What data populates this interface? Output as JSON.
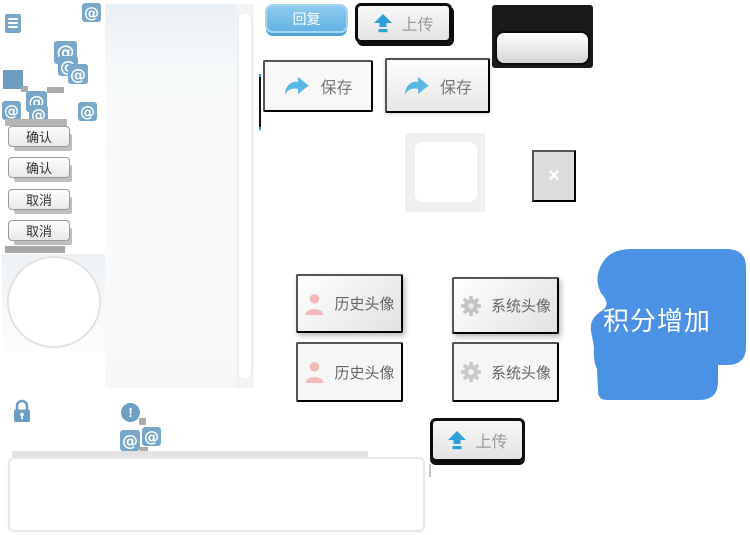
{
  "labels": {
    "reply": "回复",
    "upload": "上传",
    "save": "保存",
    "confirm": "确认",
    "cancel": "取消",
    "history_avatar": "历史头像",
    "system_avatar": "系统头像",
    "close": "×",
    "at": "@",
    "exclamation": "!",
    "points_bubble": "积分增加"
  },
  "colors": {
    "steel_blue": "#79a7c9",
    "arrow_blue": "#2d9fd9",
    "reply_blue": "#63b3e5",
    "bubble_blue": "#4b92e5",
    "person_pink": "#f2b9b9",
    "gear_gray": "#c3c3c3",
    "border_black": "#0c0c0c"
  }
}
